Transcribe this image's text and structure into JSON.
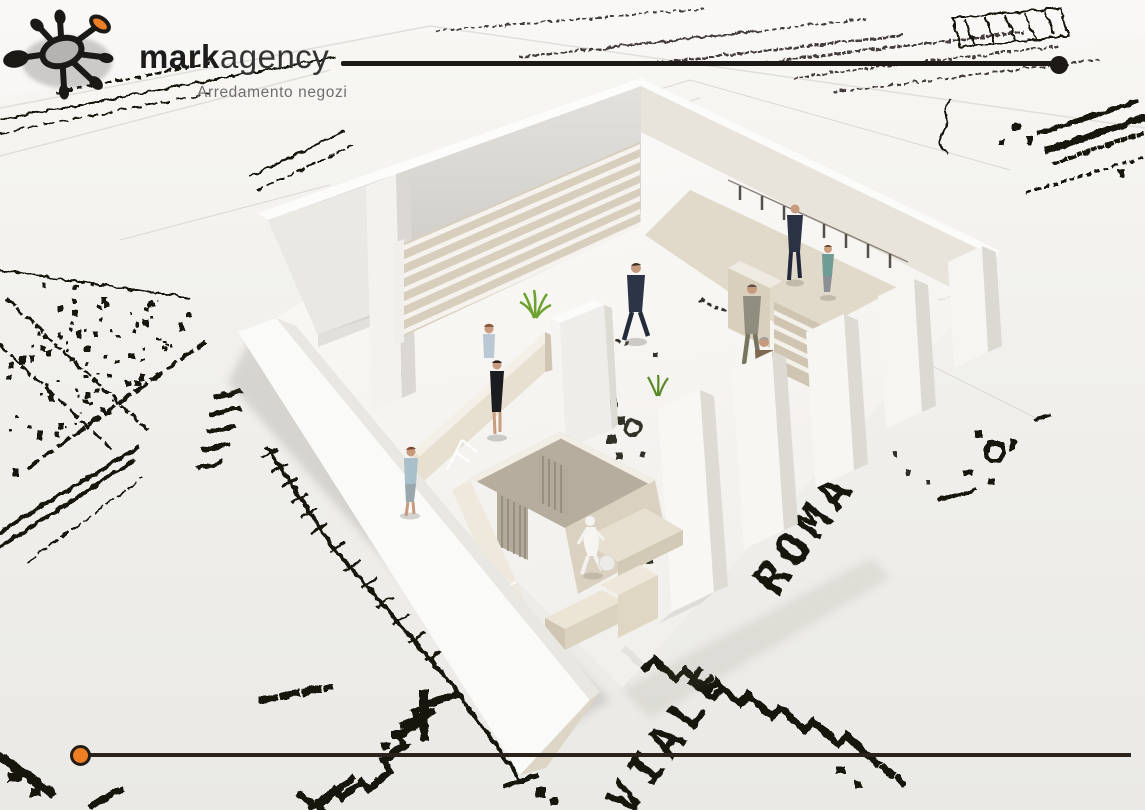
{
  "branding": {
    "logo_word_bold": "mark",
    "logo_word_light": "agency",
    "tagline": "Arredamento negozi",
    "logo_icon": "splat-asterisk-icon",
    "icon_accent_color": "#EE7E24",
    "icon_ink_color": "#1B1916",
    "icon_center_color": "#B4B3B1"
  },
  "frame": {
    "top_rule_color": "#1D1916",
    "top_rule_end_dot": "black-circle",
    "bottom_rule_color": "#29231C",
    "bottom_rule_start_dot": "orange-circle",
    "accent_orange": "#EE7E24"
  },
  "blueprint": {
    "street_label_word1": "VIALE",
    "street_label_word2": "ROMA",
    "ink_color": "#17150F",
    "paper_color": "#F1F0EC"
  },
  "model": {
    "people_count": 8,
    "wall_color": "#F5F4F1",
    "wood_color": "#D7CEBD",
    "curtain_color": "#B3AA9B",
    "plant_color": "#6DA22F"
  }
}
